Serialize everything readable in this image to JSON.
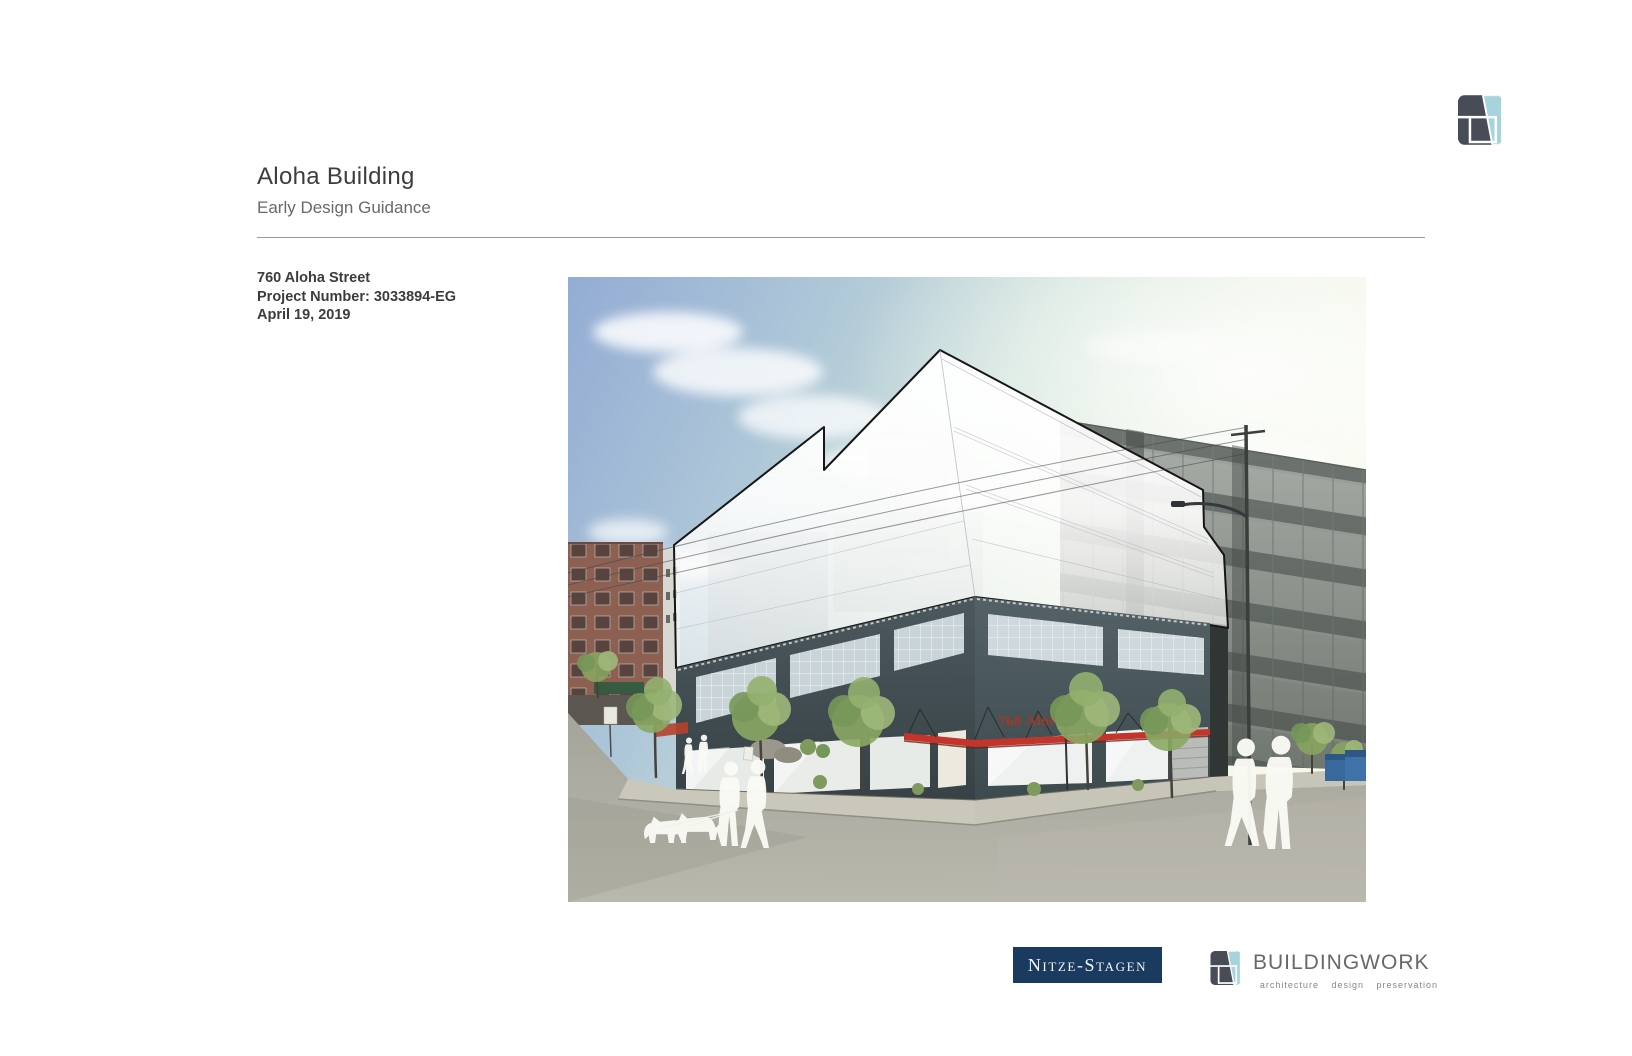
{
  "page": {
    "title": "Aloha Building",
    "subtitle": "Early Design Guidance"
  },
  "project": {
    "address": "760 Aloha Street",
    "number": "Project Number: 3033894-EG",
    "date": "April 19, 2019"
  },
  "rendering": {
    "building_sign": "760 Aloha"
  },
  "footer": {
    "nitze_stagen_label": "Nitze-Stagen",
    "buildingwork_name": "BUILDINGWORK",
    "buildingwork_tagline": "architecture design preservation"
  },
  "colors": {
    "nitze_navy": "#1b3a5f",
    "logo_dark": "#474c56",
    "logo_teal": "#a6d4dd",
    "canopy_red": "#c3342b",
    "sign_red": "#9e3a25"
  }
}
